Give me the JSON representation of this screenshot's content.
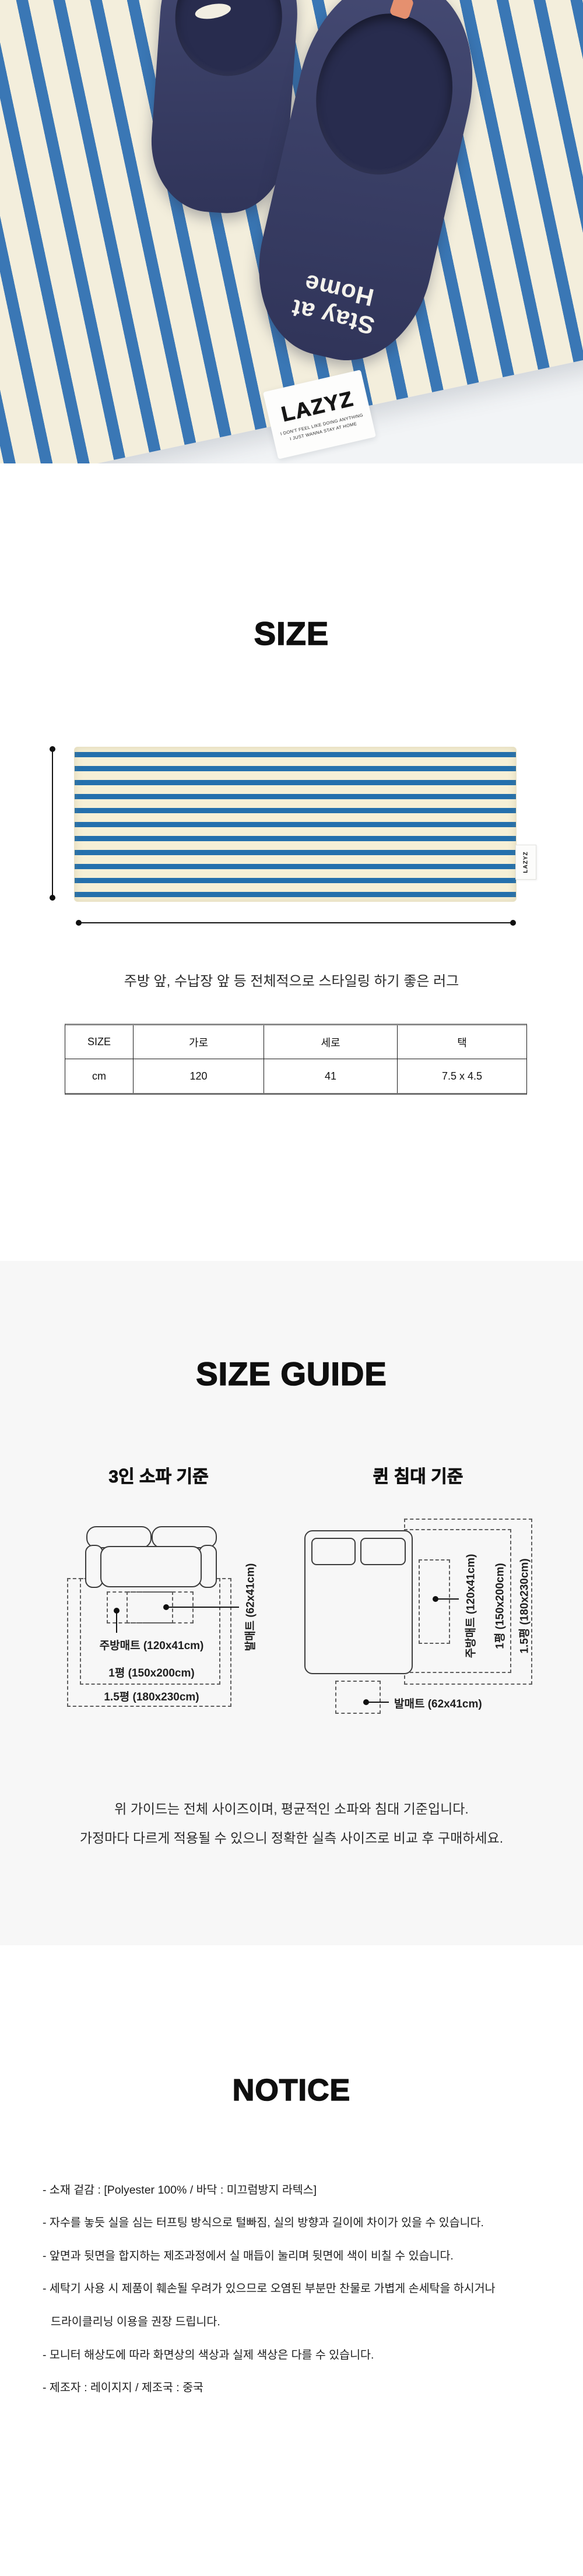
{
  "photo": {
    "slippers": {
      "line1": "Stay at",
      "line2": "Home"
    },
    "tag": {
      "brand": "LAZYZ",
      "line1": "I DON'T FEEL LIKE DOING ANYTHING",
      "line2": "I JUST WANNA STAY AT HOME"
    }
  },
  "size": {
    "heading": "SIZE",
    "caption": "주방 앞, 수납장 앞 등 전체적으로 스타일링 하기 좋은 러그",
    "side_tag": "LAZYZ",
    "table": {
      "headers": [
        "SIZE",
        "가로",
        "세로",
        "택"
      ],
      "row": [
        "cm",
        "120",
        "41",
        "7.5 x 4.5"
      ]
    }
  },
  "guide": {
    "heading": "SIZE GUIDE",
    "sofa_title": "3인 소파 기준",
    "bed_title": "퀸 침대 기준",
    "labels": {
      "kitchen": "주방매트 (120x41cm)",
      "foot": "발매트 (62x41cm)",
      "p1": "1평 (150x200cm)",
      "p15": "1.5평 (180x230cm)"
    },
    "note1": "위 가이드는 전체 사이즈이며, 평균적인 소파와 침대 기준입니다.",
    "note2": "가정마다 다르게 적용될 수 있으니 정확한 실측 사이즈로 비교 후 구매하세요."
  },
  "notice": {
    "heading": "NOTICE",
    "items": [
      "- 소재 겉감 : [Polyester 100% / 바닥 : 미끄럼방지 라텍스]",
      "- 자수를 놓듯 실을 심는 터프팅 방식으로 털빠짐, 실의 방향과 길이에 차이가 있을 수 있습니다.",
      "- 앞면과 뒷면을 합지하는 제조과정에서 실 매듭이 눌리며 뒷면에 색이 비칠 수 있습니다.",
      "- 세탁기 사용 시 제품이 훼손될 우려가 있으므로 오염된 부분만 찬물로 가볍게 손세탁을 하시거나",
      "드라이클리닝 이용을 권장 드립니다.",
      "- 모니터 해상도에 따라 화면상의 색상과 실제 색상은 다를 수 있습니다.",
      "- 제조자 : 레이지지 / 제조국 : 중국"
    ]
  },
  "colors": {
    "stripe_blue": "#2470ad",
    "photo_stripe_blue": "#3a77b5",
    "rug_cream": "#f6f0d6",
    "slipper_navy": "#3a3f66",
    "section_bg": "#f7f7f7"
  }
}
